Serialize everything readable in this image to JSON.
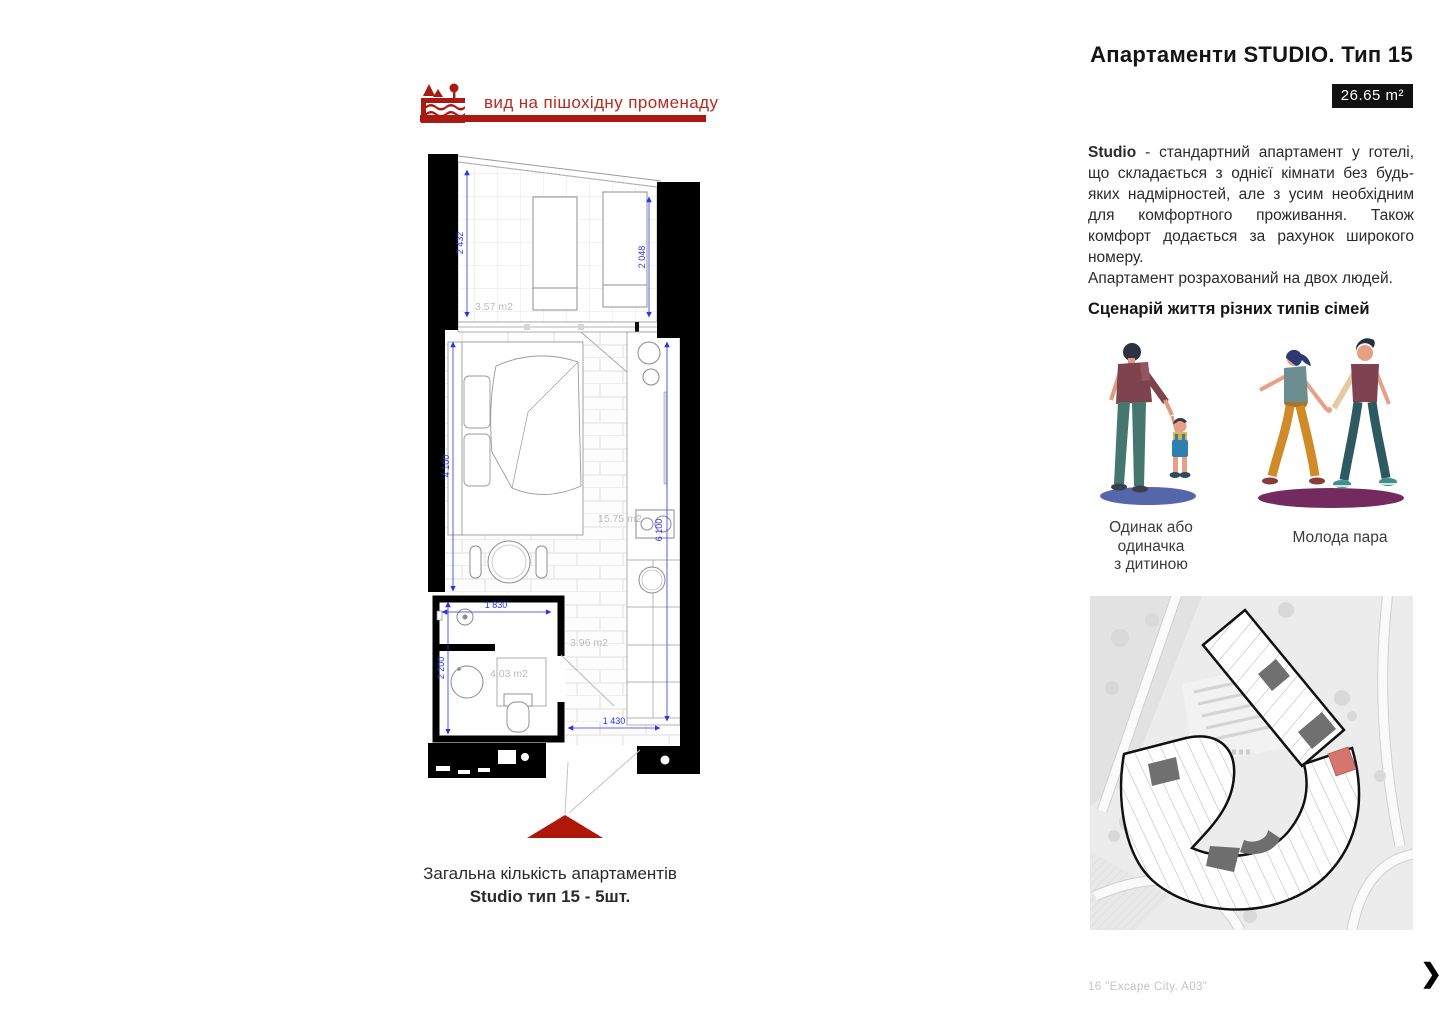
{
  "page": {
    "title": "Апартаменти STUDIO. Тип 15",
    "area_badge": "26.65 m²",
    "footer_caption": "16 \"Excape City. A03\"",
    "next_arrow": "❯"
  },
  "view_banner": {
    "label": "вид на пішохідну променаду",
    "icon": "promenade-landscape-icon",
    "color": "#a91a12"
  },
  "floor_plan": {
    "dims": {
      "balcony_left": "2 432",
      "balcony_right": "2 048",
      "room_height": "4 100",
      "room_length": "6 100",
      "shower_width": "1 830",
      "bath_height": "2 200",
      "hall_width": "1 430"
    },
    "areas": {
      "balcony": "3.57 m2",
      "room": "15.75 m2",
      "hall": "3.96 m2",
      "bathroom": "4.03 m2"
    },
    "entrance_color": "#b01708",
    "dim_color": "#2a35e8"
  },
  "plan_caption": {
    "line1": "Загальна кількість апартаментів",
    "line2": "Studio тип 15 - 5шт."
  },
  "description": {
    "lead": "Studio",
    "body": " - стандартний апартамент у готелі, що складається з однієї кімнати без будь-яких надмірностей, але з усим необхідним для комфортного проживання. Також комфорт додається за рахунок широкого номеру.",
    "body2": "Апартамент розрахований на двох людей."
  },
  "scenario": {
    "heading": "Сценарій життя різних типів сімей",
    "families": [
      {
        "caption_lines": [
          "Одинак або",
          "одиначка",
          "з дитиною"
        ]
      },
      {
        "caption_lines": [
          "Молода пара"
        ]
      }
    ]
  },
  "site_plan": {
    "highlight_color": "#d4766d"
  }
}
